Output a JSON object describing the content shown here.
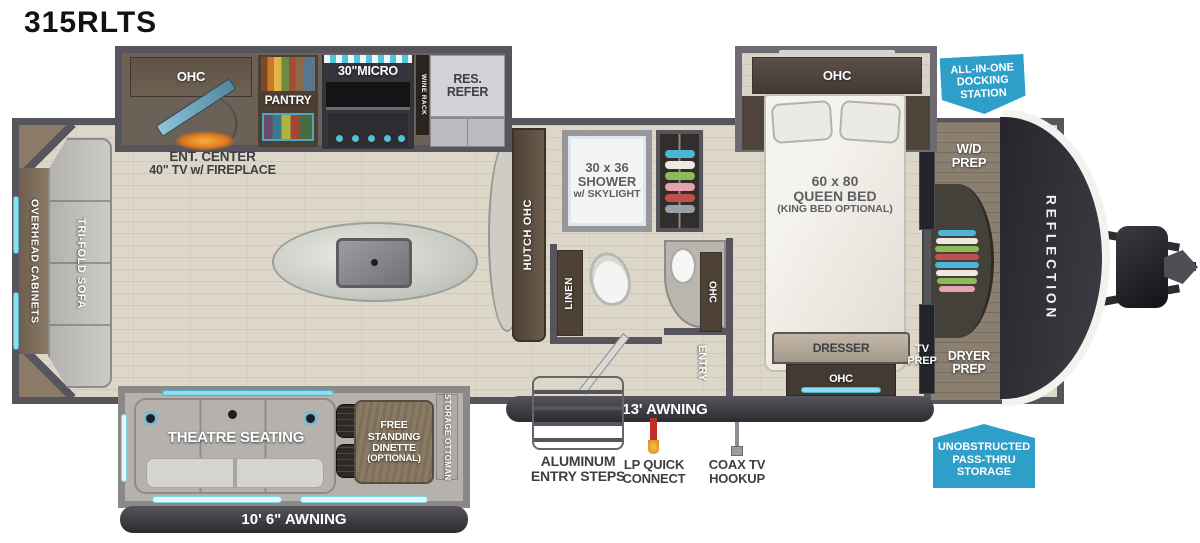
{
  "title": "315RLTS",
  "front_brand": "REFLECTION",
  "kitchen": {
    "ohc": "OHC",
    "ent1": "ENT. CENTER",
    "ent2": "40\" TV w/ FIREPLACE",
    "pantry": "PANTRY",
    "micro": "30\"MICRO",
    "wine": "WINE RACK",
    "refer1": "RES.",
    "refer2": "REFER",
    "hutch": "HUTCH OHC"
  },
  "living": {
    "cabinets": "OVERHEAD CABINETS",
    "sofa": "TRI-FOLD SOFA"
  },
  "bath": {
    "shower1": "30 x 36",
    "shower2": "SHOWER",
    "shower3": "w/ SKYLIGHT",
    "linen": "LINEN",
    "ohc": "OHC",
    "entry": "ENTRY"
  },
  "bedroom": {
    "ohc": "OHC",
    "bed1": "60 x 80",
    "bed2": "QUEEN BED",
    "bed3": "(KING BED OPTIONAL)",
    "dresser": "DRESSER",
    "dresser_ohc": "OHC",
    "tv1": "TV",
    "tv2": "PREP",
    "wd1": "W/D",
    "wd2": "PREP",
    "dryer1": "DRYER",
    "dryer2": "PREP"
  },
  "slideout": {
    "theatre": "THEATRE SEATING",
    "din1": "FREE",
    "din2": "STANDING",
    "din3": "DINETTE",
    "din4": "(OPTIONAL)",
    "ottoman": "STORAGE OTTOMAN"
  },
  "exterior": {
    "awning_rear": "10' 6\" AWNING",
    "awning_main": "13' AWNING",
    "steps1": "ALUMINUM",
    "steps2": "ENTRY STEPS",
    "lp1": "LP QUICK",
    "lp2": "CONNECT",
    "coax1": "COAX TV",
    "coax2": "HOOKUP"
  },
  "callouts": {
    "dock1": "ALL-IN-ONE",
    "dock2": "DOCKING",
    "dock3": "STATION",
    "pass1": "UNOBSTRUCTED",
    "pass2": "PASS-THRU",
    "pass3": "STORAGE"
  },
  "colors": {
    "badge_blue": "#2e9fc9",
    "teal_accent": "#6fd0e8",
    "wall_gray": "#56545c",
    "awning_bar": "#35343a",
    "floor_beige": "#ddd7ca",
    "cap_dark": "#2b2a30"
  }
}
